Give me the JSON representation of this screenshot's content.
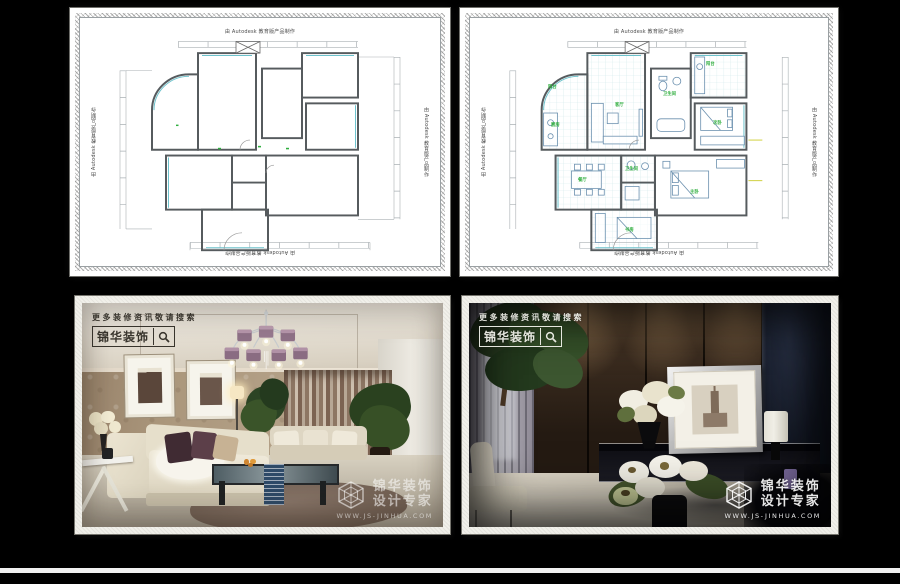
{
  "page": {
    "background": "#000000"
  },
  "cad": {
    "stamp": "由 Autodesk 教育版产品制作",
    "room_labels": [
      "客厅",
      "餐厅",
      "厨房",
      "主卧",
      "次卧",
      "书房",
      "卫生间",
      "阳台"
    ],
    "colors": {
      "wall": "#565b5e",
      "accent": "#6cc2cc",
      "dimension": "#aab0b4",
      "label": "#2fae3e"
    }
  },
  "watermark": {
    "search_hint": "更多装修资讯敬请搜索",
    "brand": "锦华装饰",
    "logo_name": "锦华装饰",
    "logo_tagline": "设计专家",
    "website": "WWW.JS-JINHUA.COM"
  }
}
